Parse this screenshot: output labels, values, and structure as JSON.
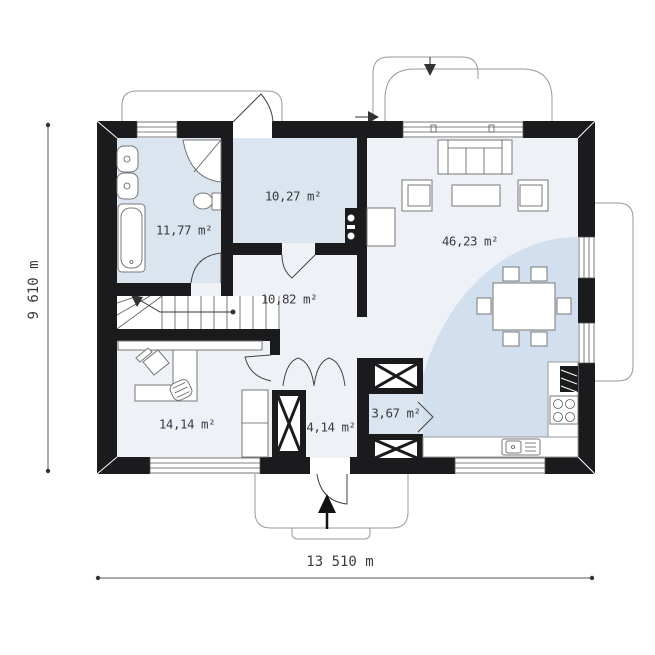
{
  "colors": {
    "wall": "#1b1b1e",
    "room": "#dbe5f0",
    "floor": "#eef2f7",
    "zone": "#d2dfee"
  },
  "rooms": [
    {
      "name": "bathroom",
      "area": "11,77 m²"
    },
    {
      "name": "bedroom",
      "area": "10,27 m²"
    },
    {
      "name": "hall",
      "area": "10,82 m²"
    },
    {
      "name": "living-room",
      "area": "46,23 m²"
    },
    {
      "name": "office",
      "area": "14,14 m²"
    },
    {
      "name": "entry",
      "area": "4,14 m²"
    },
    {
      "name": "pantry",
      "area": "3,67 m²"
    }
  ],
  "dimensions": {
    "width": "13 510 m",
    "height": "9 610 m"
  }
}
